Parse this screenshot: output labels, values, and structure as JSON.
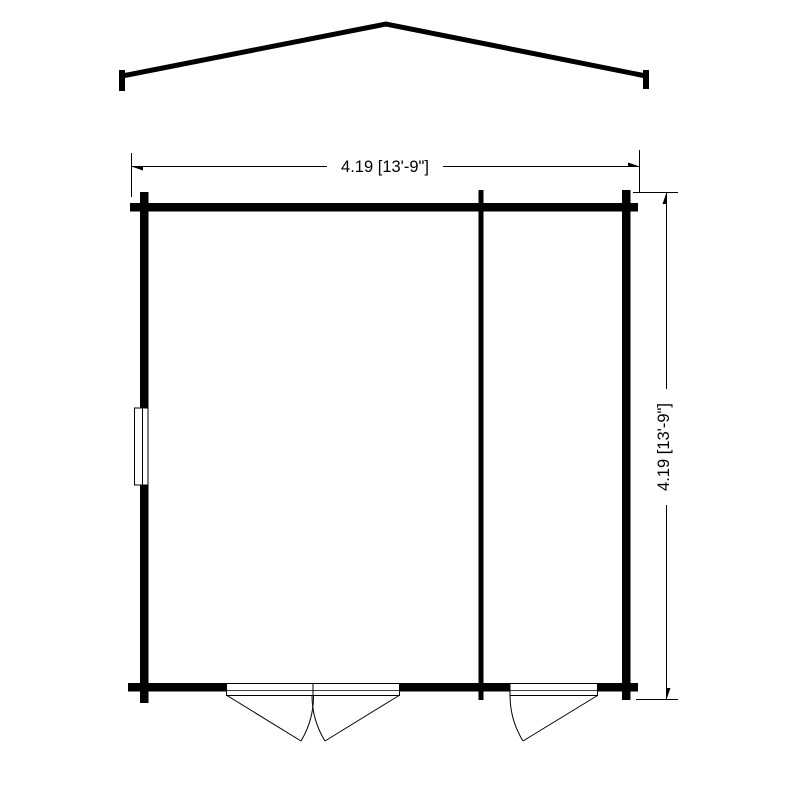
{
  "drawing": {
    "title": "garden-building-floor-plan",
    "background": "#ffffff",
    "line_color": "#000000",
    "dimensions": {
      "width_label": "4.19 [13'-9\"]",
      "depth_label": "4.19 [13'-9\"]"
    }
  }
}
